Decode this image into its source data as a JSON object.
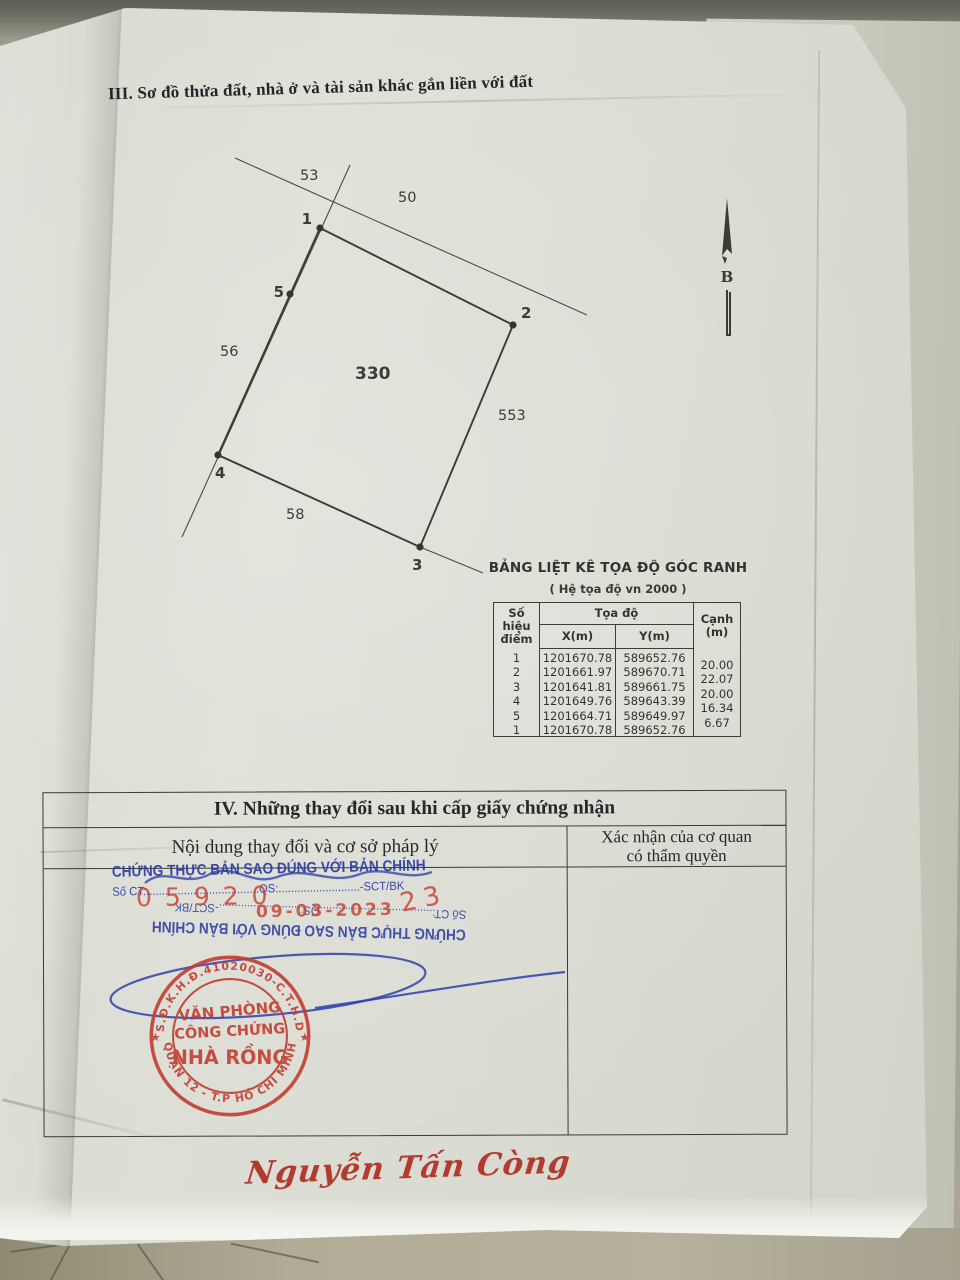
{
  "section3": {
    "title": "III. Sơ đồ thửa đất, nhà ở và tài sản khác gắn liền với đất"
  },
  "diagram": {
    "parcel_number": "330",
    "point_labels": {
      "p1": "1",
      "p2": "2",
      "p3": "3",
      "p4": "4",
      "p5": "5"
    },
    "map_labels": {
      "top_left": "53",
      "top_right": "50",
      "left": "56",
      "bottom": "58",
      "right": "553"
    },
    "north_letter": "B"
  },
  "coord_table": {
    "title": "BẢNG LIỆT KÊ TỌA ĐỘ GÓC RANH",
    "subtitle": "( Hệ tọa độ vn 2000 )",
    "col_point_1": "Số hiệu",
    "col_point_2": "điểm",
    "col_coord": "Tọa độ",
    "col_x": "X(m)",
    "col_y": "Y(m)",
    "col_edge_1": "Cạnh",
    "col_edge_2": "(m)",
    "rows": [
      {
        "id": "1",
        "x": "1201670.78",
        "y": "589652.76"
      },
      {
        "id": "2",
        "x": "1201661.97",
        "y": "589670.71"
      },
      {
        "id": "3",
        "x": "1201641.81",
        "y": "589661.75"
      },
      {
        "id": "4",
        "x": "1201649.76",
        "y": "589643.39"
      },
      {
        "id": "5",
        "x": "1201664.71",
        "y": "589649.97"
      },
      {
        "id": "1b",
        "x": "1201670.78",
        "y": "589652.76"
      }
    ],
    "ids_joined": "1\n2\n3\n4\n5\n1",
    "edges": [
      "20.00",
      "22.07",
      "20.00",
      "16.34",
      "6.67"
    ]
  },
  "section4": {
    "title": "IV. Những thay đổi sau khi cấp giấy chứng nhận",
    "col_left": "Nội dung thay đổi và cơ sở pháp lý",
    "col_right_line1": "Xác nhận của cơ quan",
    "col_right_line2": "có thẩm quyền"
  },
  "stamps": {
    "blue_line1": "CHỨNG THỰC BẢN SAO ĐÚNG VỚI BẢN CHÍNH",
    "blue_line2": "Số CT:....................................QS:..........................-SCT/BK",
    "red_number": "05920",
    "red_number2": "23",
    "red_date": "09-03-2023",
    "round": {
      "ring_top": "S.Đ.K.H.Đ.41020030-C.T.H.D",
      "ring_bottom": "QUẬN 12 - T.P HỒ CHÍ MINH",
      "star_left": "★",
      "star_right": "★",
      "center1": "VĂN PHÒNG",
      "center2": "CÔNG CHỨNG",
      "center3": "NHÀ RỒNG"
    }
  },
  "signature": {
    "name": "Nguyễn Tấn Còng"
  },
  "colors": {
    "blue_ink": "#2c3da3",
    "red_stamp": "#c23d30",
    "paper": "#d9dad1",
    "surface": "#a8a497"
  }
}
